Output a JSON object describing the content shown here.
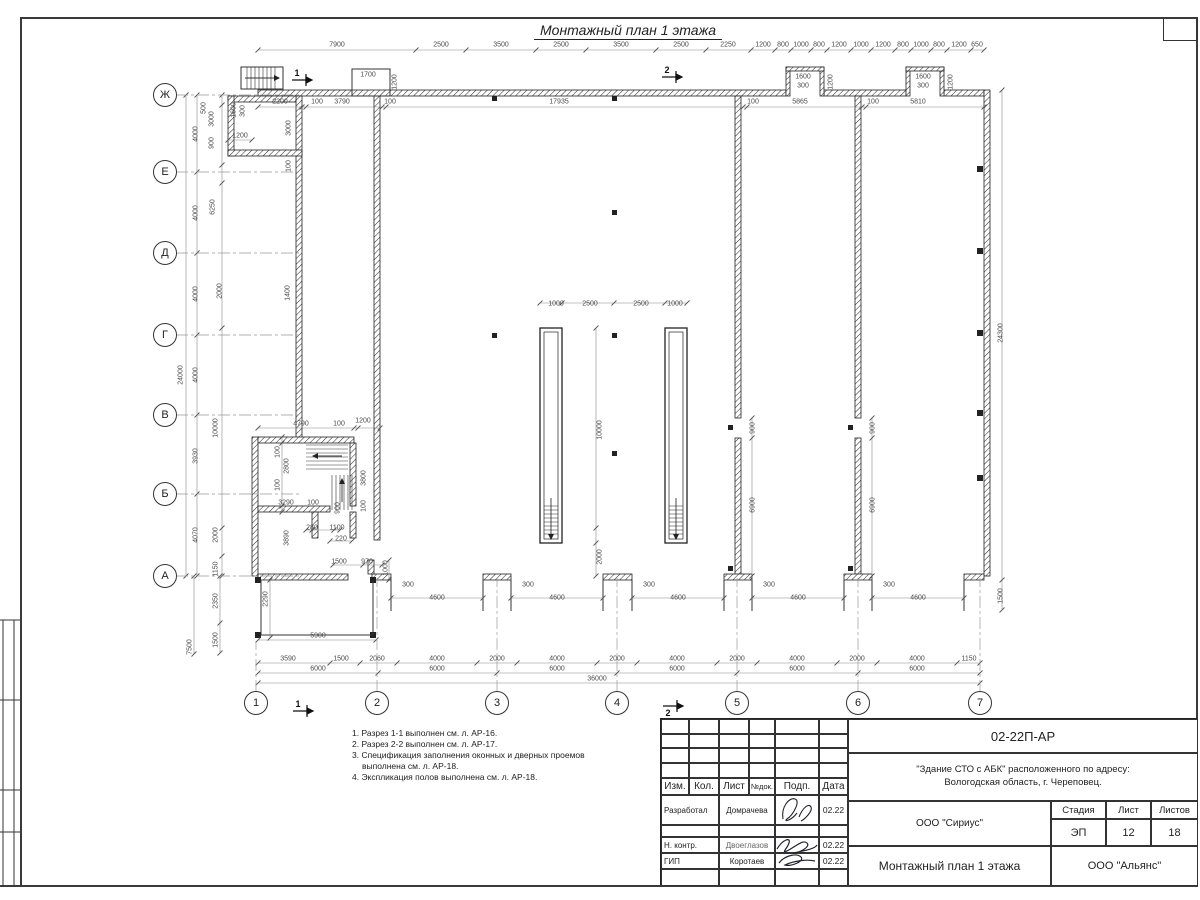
{
  "sheet": {
    "title": "Монтажный план 1 этажа"
  },
  "axes": {
    "v": [
      "Ж",
      "Е",
      "Д",
      "Г",
      "В",
      "Б",
      "А"
    ],
    "h": [
      "1",
      "2",
      "3",
      "4",
      "5",
      "6",
      "7"
    ]
  },
  "sections": {
    "s1": "1",
    "s2": "2"
  },
  "d": {
    "t1": [
      "7900",
      "2500",
      "3500",
      "2500",
      "3500",
      "2500",
      "2250",
      "1200",
      "800",
      "1000",
      "800",
      "1200",
      "1000",
      "1200",
      "800",
      "1000",
      "800",
      "1200",
      "650"
    ],
    "t2": [
      "2200",
      "100",
      "3790",
      "100",
      "17935",
      "100",
      "5865",
      "100",
      "5810"
    ],
    "tl": [
      "1600",
      "300",
      "1200",
      "3000",
      "100"
    ],
    "lm": [
      "500",
      "3000",
      "900"
    ],
    "lo": "24000",
    "ls": [
      "4000",
      "4000",
      "4000",
      "4000",
      "3930",
      "4070"
    ],
    "li": [
      "6250",
      "2000",
      "1400",
      "10000",
      "2000",
      "1150"
    ],
    "lb": [
      "7500",
      "2350",
      "1500"
    ],
    "rt": [
      "24300",
      "1500"
    ],
    "cn": [
      "1700",
      "1200"
    ],
    "p1": [
      "1600",
      "300",
      "1200"
    ],
    "p2": [
      "1600",
      "300",
      "1200"
    ],
    "sh": [
      "1000",
      "2500",
      "2500",
      "1000",
      "10000",
      "2000"
    ],
    "st": [
      "4790",
      "100",
      "1200",
      "100",
      "2800",
      "100",
      "3290",
      "100",
      "900",
      "3800",
      "100",
      "280",
      "1100",
      "220",
      "3890"
    ],
    "dr": [
      "900",
      "6900",
      "900",
      "6900"
    ],
    "by": [
      "300",
      "4600",
      "300",
      "4600",
      "300",
      "4600",
      "300",
      "4600",
      "300",
      "4600"
    ],
    "b0": [
      "1500",
      "970",
      "1000",
      "2290",
      "5900"
    ],
    "b1": [
      "3590",
      "1500",
      "2060",
      "4000",
      "2000",
      "4000",
      "2000",
      "4000",
      "2000",
      "4000",
      "2000",
      "4000",
      "1150"
    ],
    "b2": [
      "6000",
      "6000",
      "6000",
      "6000",
      "6000",
      "6000"
    ],
    "b3": "36000"
  },
  "notes": [
    "1. Разрез 1-1 выполнен см. л. АР-16.",
    "2. Разрез 2-2 выполнен см. л. АР-17.",
    "3. Спецификация заполнения оконных и дверных проемов выполнена см. л. АР-18.",
    "4. Экспликация полов выполнена см. л. АР-18."
  ],
  "tb": {
    "code": "02-22П-АР",
    "obj1": "\"Здание СТО с АБК\" расположенного по адресу:",
    "obj2": "Вологодская область, г. Череповец.",
    "cols": [
      "Изм.",
      "Кол.",
      "Лист",
      "№док.",
      "Подп.",
      "Дата"
    ],
    "r1": {
      "role": "Разработал",
      "name": "Домрачева",
      "date": "02.22"
    },
    "r2": {
      "role": "Н. контр.",
      "name": "Двоеглазов",
      "date": "02.22"
    },
    "r3": {
      "role": "ГИП",
      "name": "Коротаев",
      "date": "02.22"
    },
    "org": "ООО \"Сириус\"",
    "sh": [
      "Стадия",
      "Лист",
      "Листов"
    ],
    "sv": [
      "ЭП",
      "12",
      "18"
    ],
    "draw": "Монтажный план 1 этажа",
    "firm": "ООО \"Альянс\""
  }
}
